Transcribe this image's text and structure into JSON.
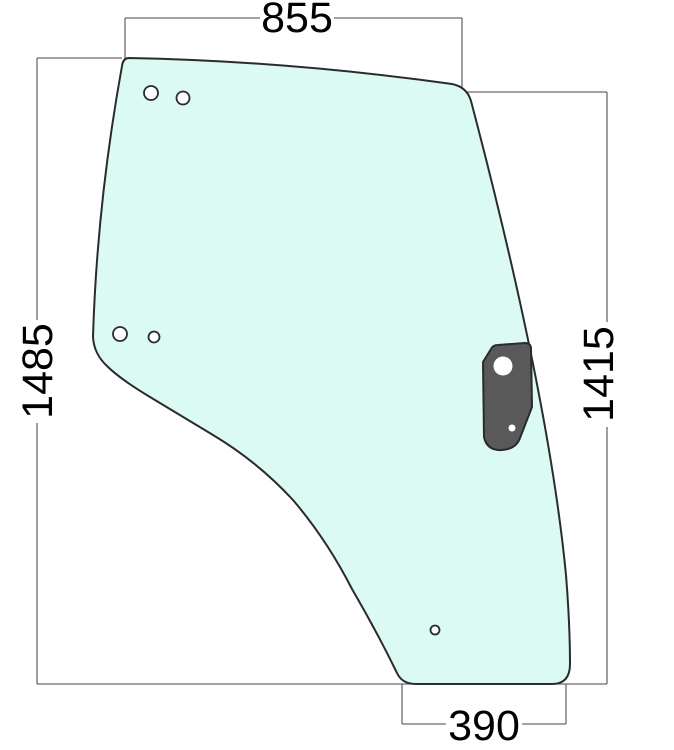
{
  "drawing": {
    "type": "technical-part-drawing",
    "part_name": "door-glass-panel-with-hinge-bracket",
    "dimensions": {
      "top_width": "855",
      "left_height": "1485",
      "right_height": "1415",
      "bottom_width": "390"
    },
    "colors": {
      "background": "#ffffff",
      "glass_fill": "#dafaf3",
      "glass_outline": "#2b2b2b",
      "bracket_fill": "#595959",
      "bracket_outline": "#1a1a1a",
      "dimension_line": "#6a6a6a",
      "dimension_text": "#000000"
    }
  }
}
